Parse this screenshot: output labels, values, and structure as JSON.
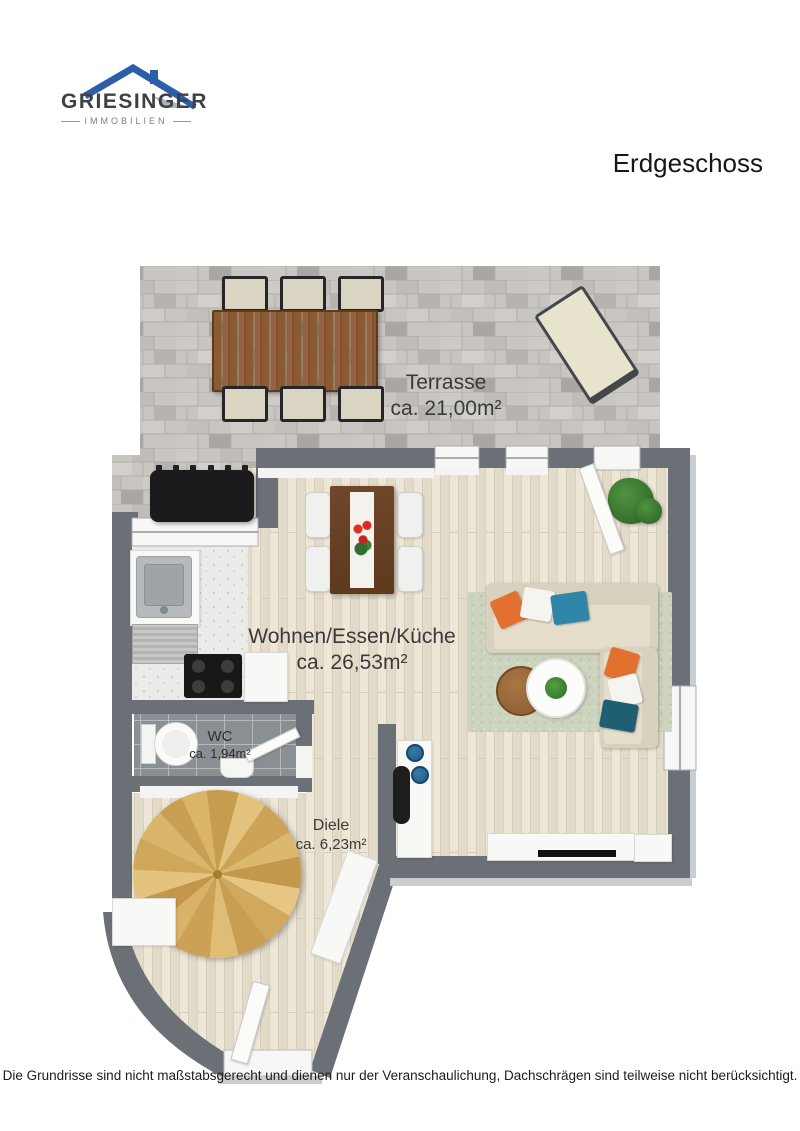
{
  "logo": {
    "brand": "GRIESINGER",
    "subtitle": "IMMOBILIEN"
  },
  "header": {
    "title": "Erdgeschoss"
  },
  "rooms": [
    {
      "id": "terrasse",
      "name": "Terrasse",
      "area": "ca. 21,00m²"
    },
    {
      "id": "wohnen-essen-kueche",
      "name": "Wohnen/Essen/Küche",
      "area": "ca. 26,53m²"
    },
    {
      "id": "wc",
      "name": "WC",
      "area": "ca. 1,94m²"
    },
    {
      "id": "diele",
      "name": "Diele",
      "area": "ca. 6,23m²"
    }
  ],
  "footer": {
    "disclaimer": "Die Grundrisse sind nicht maßstabsgerecht und dienen nur der Veranschaulichung, Dachschrägen sind teilweise nicht berücksichtigt."
  },
  "colors": {
    "wall": "#6a7076",
    "logo_blue": "#2d5fa8",
    "floor_wood": "#e8e1d2",
    "terrace_paving": "#c9c6c1",
    "pillow_orange": "#e2702f",
    "pillow_blue": "#2f86a8",
    "stair_wood": "#d2ab60"
  }
}
